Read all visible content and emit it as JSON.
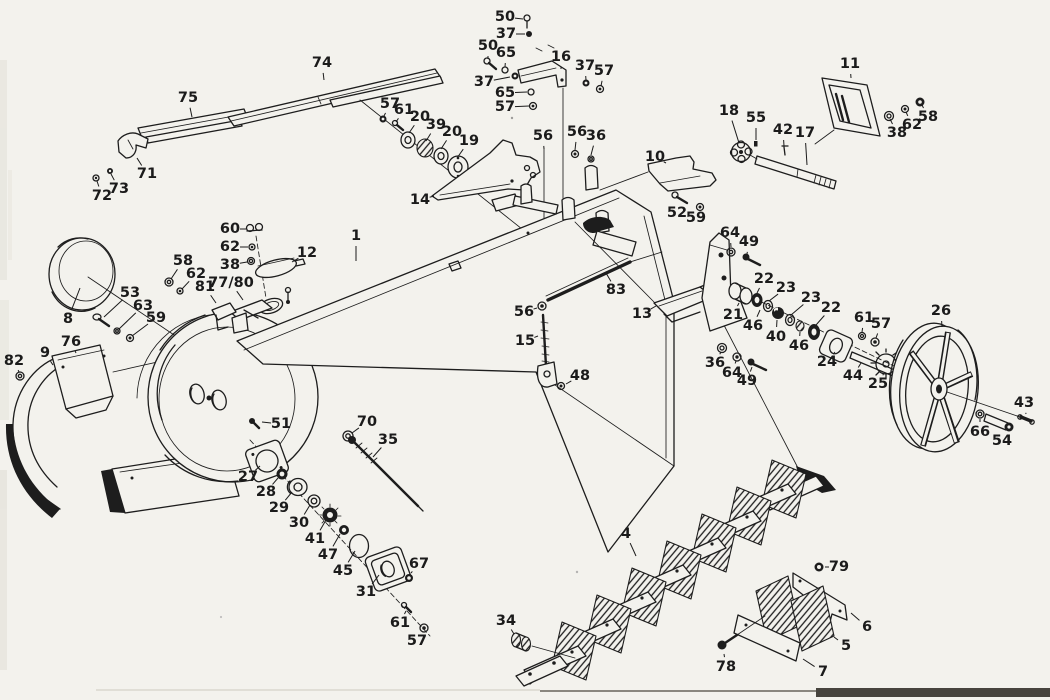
{
  "diagram": {
    "kind": "exploded-parts-diagram",
    "colors": {
      "ink": "#1d1d1d",
      "paper": "#f3f2ed",
      "page_edge": "#47443e"
    },
    "callouts": [
      {
        "n": "74",
        "x": 322,
        "y": 63,
        "tx": 324,
        "ty": 80
      },
      {
        "n": "75",
        "x": 188,
        "y": 98,
        "tx": 192,
        "ty": 117
      },
      {
        "n": "71",
        "x": 147,
        "y": 174,
        "tx": 137,
        "ty": 158
      },
      {
        "n": "73",
        "x": 119,
        "y": 189,
        "tx": 111,
        "ty": 174
      },
      {
        "n": "72",
        "x": 102,
        "y": 196,
        "tx": 97,
        "ty": 181
      },
      {
        "n": "50",
        "x": 505,
        "y": 17,
        "tx": 523,
        "ty": 19
      },
      {
        "n": "37",
        "x": 506,
        "y": 34,
        "tx": 525,
        "ty": 34
      },
      {
        "n": "50",
        "x": 488,
        "y": 46,
        "tx": 488,
        "ty": 59
      },
      {
        "n": "65",
        "x": 506,
        "y": 53,
        "tx": 505,
        "ty": 67
      },
      {
        "n": "37",
        "x": 484,
        "y": 82,
        "tx": 510,
        "ty": 77
      },
      {
        "n": "16",
        "x": 561,
        "y": 57,
        "tx": 561,
        "ty": 69
      },
      {
        "n": "37",
        "x": 585,
        "y": 66,
        "tx": 586,
        "ty": 80
      },
      {
        "n": "57",
        "x": 604,
        "y": 71,
        "tx": 601,
        "ty": 86
      },
      {
        "n": "65",
        "x": 505,
        "y": 93,
        "tx": 527,
        "ty": 92
      },
      {
        "n": "57",
        "x": 505,
        "y": 107,
        "tx": 529,
        "ty": 106
      },
      {
        "n": "57",
        "x": 390,
        "y": 104,
        "tx": 384,
        "ty": 116
      },
      {
        "n": "61",
        "x": 404,
        "y": 110,
        "tx": 396,
        "ty": 122
      },
      {
        "n": "20",
        "x": 420,
        "y": 117,
        "tx": 409,
        "ty": 133
      },
      {
        "n": "39",
        "x": 436,
        "y": 125,
        "tx": 426,
        "ty": 141
      },
      {
        "n": "20",
        "x": 452,
        "y": 132,
        "tx": 441,
        "ty": 149
      },
      {
        "n": "19",
        "x": 469,
        "y": 141,
        "tx": 457,
        "ty": 158
      },
      {
        "n": "14",
        "x": 420,
        "y": 200,
        "tx": 434,
        "ty": 196
      },
      {
        "n": "56",
        "x": 543,
        "y": 136,
        "tx": 544,
        "ty": 149
      },
      {
        "n": "56",
        "x": 577,
        "y": 132,
        "tx": 575,
        "ty": 150
      },
      {
        "n": "36",
        "x": 596,
        "y": 136,
        "tx": 591,
        "ty": 155
      },
      {
        "n": "10",
        "x": 655,
        "y": 157,
        "tx": 666,
        "ty": 163
      },
      {
        "n": "52",
        "x": 677,
        "y": 213,
        "tx": 680,
        "ty": 203
      },
      {
        "n": "59",
        "x": 696,
        "y": 218,
        "tx": 700,
        "ty": 210
      },
      {
        "n": "11",
        "x": 850,
        "y": 64,
        "tx": 851,
        "ty": 78
      },
      {
        "n": "18",
        "x": 729,
        "y": 111,
        "tx": 739,
        "ty": 143
      },
      {
        "n": "55",
        "x": 756,
        "y": 118,
        "tx": 756,
        "ty": 140
      },
      {
        "n": "42",
        "x": 783,
        "y": 130,
        "tx": 784,
        "ty": 146
      },
      {
        "n": "17",
        "x": 805,
        "y": 133,
        "tx": 807,
        "ty": 165
      },
      {
        "n": "38",
        "x": 897,
        "y": 133,
        "tx": 890,
        "ty": 119
      },
      {
        "n": "62",
        "x": 912,
        "y": 125,
        "tx": 906,
        "ty": 112
      },
      {
        "n": "58",
        "x": 928,
        "y": 117,
        "tx": 922,
        "ty": 105
      },
      {
        "n": "8",
        "x": 68,
        "y": 319,
        "tx": 80,
        "ty": 288
      },
      {
        "n": "58",
        "x": 183,
        "y": 261,
        "tx": 171,
        "ty": 279
      },
      {
        "n": "62",
        "x": 196,
        "y": 274,
        "tx": 182,
        "ty": 289
      },
      {
        "n": "53",
        "x": 130,
        "y": 293,
        "tx": 104,
        "ty": 317
      },
      {
        "n": "63",
        "x": 143,
        "y": 306,
        "tx": 119,
        "ty": 329
      },
      {
        "n": "59",
        "x": 156,
        "y": 318,
        "tx": 132,
        "ty": 336
      },
      {
        "n": "76",
        "x": 71,
        "y": 342,
        "tx": 76,
        "ty": 353
      },
      {
        "n": "9",
        "x": 45,
        "y": 353,
        "tx": 53,
        "ty": 365
      },
      {
        "n": "82",
        "x": 14,
        "y": 361,
        "tx": 19,
        "ty": 372
      },
      {
        "n": "60",
        "x": 230,
        "y": 229,
        "tx": 246,
        "ty": 229
      },
      {
        "n": "62",
        "x": 230,
        "y": 247,
        "tx": 248,
        "ty": 247
      },
      {
        "n": "38",
        "x": 230,
        "y": 265,
        "tx": 247,
        "ty": 262
      },
      {
        "n": "12",
        "x": 307,
        "y": 253,
        "tx": 292,
        "ty": 262
      },
      {
        "n": "1",
        "x": 356,
        "y": 236,
        "tx": 356,
        "ty": 261
      },
      {
        "n": "81",
        "x": 205,
        "y": 287,
        "tx": 216,
        "ty": 303
      },
      {
        "n": "77/80",
        "x": 231,
        "y": 283,
        "tx": 243,
        "ty": 300
      },
      {
        "n": "51",
        "x": 281,
        "y": 424,
        "tx": 262,
        "ty": 422
      },
      {
        "n": "83",
        "x": 616,
        "y": 290,
        "tx": 606,
        "ty": 273
      },
      {
        "n": "13",
        "x": 642,
        "y": 314,
        "tx": 656,
        "ty": 306
      },
      {
        "n": "56",
        "x": 524,
        "y": 312,
        "tx": 537,
        "ty": 308
      },
      {
        "n": "15",
        "x": 525,
        "y": 341,
        "tx": 538,
        "ty": 336
      },
      {
        "n": "48",
        "x": 580,
        "y": 376,
        "tx": 566,
        "ty": 384
      },
      {
        "n": "70",
        "x": 367,
        "y": 422,
        "tx": 352,
        "ty": 433
      },
      {
        "n": "35",
        "x": 388,
        "y": 440,
        "tx": 373,
        "ty": 457
      },
      {
        "n": "64",
        "x": 730,
        "y": 233,
        "tx": 731,
        "ty": 247
      },
      {
        "n": "49",
        "x": 749,
        "y": 242,
        "tx": 747,
        "ty": 254
      },
      {
        "n": "22",
        "x": 764,
        "y": 279,
        "tx": 757,
        "ty": 293
      },
      {
        "n": "23",
        "x": 786,
        "y": 288,
        "tx": 769,
        "ty": 301
      },
      {
        "n": "23",
        "x": 811,
        "y": 298,
        "tx": 791,
        "ty": 315
      },
      {
        "n": "22",
        "x": 831,
        "y": 308,
        "tx": 816,
        "ty": 325
      },
      {
        "n": "21",
        "x": 733,
        "y": 315,
        "tx": 739,
        "ty": 303
      },
      {
        "n": "46",
        "x": 753,
        "y": 326,
        "tx": 760,
        "ty": 310
      },
      {
        "n": "40",
        "x": 776,
        "y": 337,
        "tx": 777,
        "ty": 320
      },
      {
        "n": "46",
        "x": 799,
        "y": 346,
        "tx": 800,
        "ty": 332
      },
      {
        "n": "61",
        "x": 864,
        "y": 318,
        "tx": 862,
        "ty": 332
      },
      {
        "n": "57",
        "x": 881,
        "y": 324,
        "tx": 876,
        "ty": 338
      },
      {
        "n": "24",
        "x": 827,
        "y": 362,
        "tx": 835,
        "ty": 352
      },
      {
        "n": "44",
        "x": 853,
        "y": 376,
        "tx": 861,
        "ty": 363
      },
      {
        "n": "25",
        "x": 878,
        "y": 384,
        "tx": 884,
        "ty": 373
      },
      {
        "n": "26",
        "x": 941,
        "y": 311,
        "tx": 942,
        "ty": 327
      },
      {
        "n": "36",
        "x": 715,
        "y": 363,
        "tx": 721,
        "ty": 352
      },
      {
        "n": "64",
        "x": 732,
        "y": 373,
        "tx": 736,
        "ty": 361
      },
      {
        "n": "49",
        "x": 747,
        "y": 381,
        "tx": 752,
        "ty": 367
      },
      {
        "n": "43",
        "x": 1024,
        "y": 403,
        "tx": 1026,
        "ty": 414
      },
      {
        "n": "66",
        "x": 980,
        "y": 432,
        "tx": 980,
        "ty": 419
      },
      {
        "n": "54",
        "x": 1002,
        "y": 441,
        "tx": 1000,
        "ty": 431
      },
      {
        "n": "27",
        "x": 248,
        "y": 477,
        "tx": 260,
        "ty": 466
      },
      {
        "n": "28",
        "x": 266,
        "y": 492,
        "tx": 278,
        "ty": 478
      },
      {
        "n": "29",
        "x": 279,
        "y": 508,
        "tx": 292,
        "ty": 492
      },
      {
        "n": "30",
        "x": 299,
        "y": 523,
        "tx": 310,
        "ty": 505
      },
      {
        "n": "41",
        "x": 315,
        "y": 539,
        "tx": 326,
        "ty": 520
      },
      {
        "n": "47",
        "x": 328,
        "y": 555,
        "tx": 340,
        "ty": 534
      },
      {
        "n": "45",
        "x": 343,
        "y": 571,
        "tx": 355,
        "ty": 551
      },
      {
        "n": "31",
        "x": 366,
        "y": 592,
        "tx": 379,
        "ty": 575
      },
      {
        "n": "67",
        "x": 419,
        "y": 564,
        "tx": 411,
        "ty": 573
      },
      {
        "n": "61",
        "x": 400,
        "y": 623,
        "tx": 406,
        "ty": 611
      },
      {
        "n": "57",
        "x": 417,
        "y": 641,
        "tx": 422,
        "ty": 632
      },
      {
        "n": "34",
        "x": 506,
        "y": 621,
        "tx": 514,
        "ty": 634
      },
      {
        "n": "4",
        "x": 626,
        "y": 534,
        "tx": 636,
        "ty": 556
      },
      {
        "n": "79",
        "x": 839,
        "y": 567,
        "tx": 825,
        "ty": 567
      },
      {
        "n": "6",
        "x": 867,
        "y": 627,
        "tx": 851,
        "ty": 613
      },
      {
        "n": "5",
        "x": 846,
        "y": 646,
        "tx": 834,
        "ty": 637
      },
      {
        "n": "7",
        "x": 823,
        "y": 672,
        "tx": 803,
        "ty": 659
      },
      {
        "n": "78",
        "x": 726,
        "y": 667,
        "tx": 724,
        "ty": 654
      }
    ]
  }
}
